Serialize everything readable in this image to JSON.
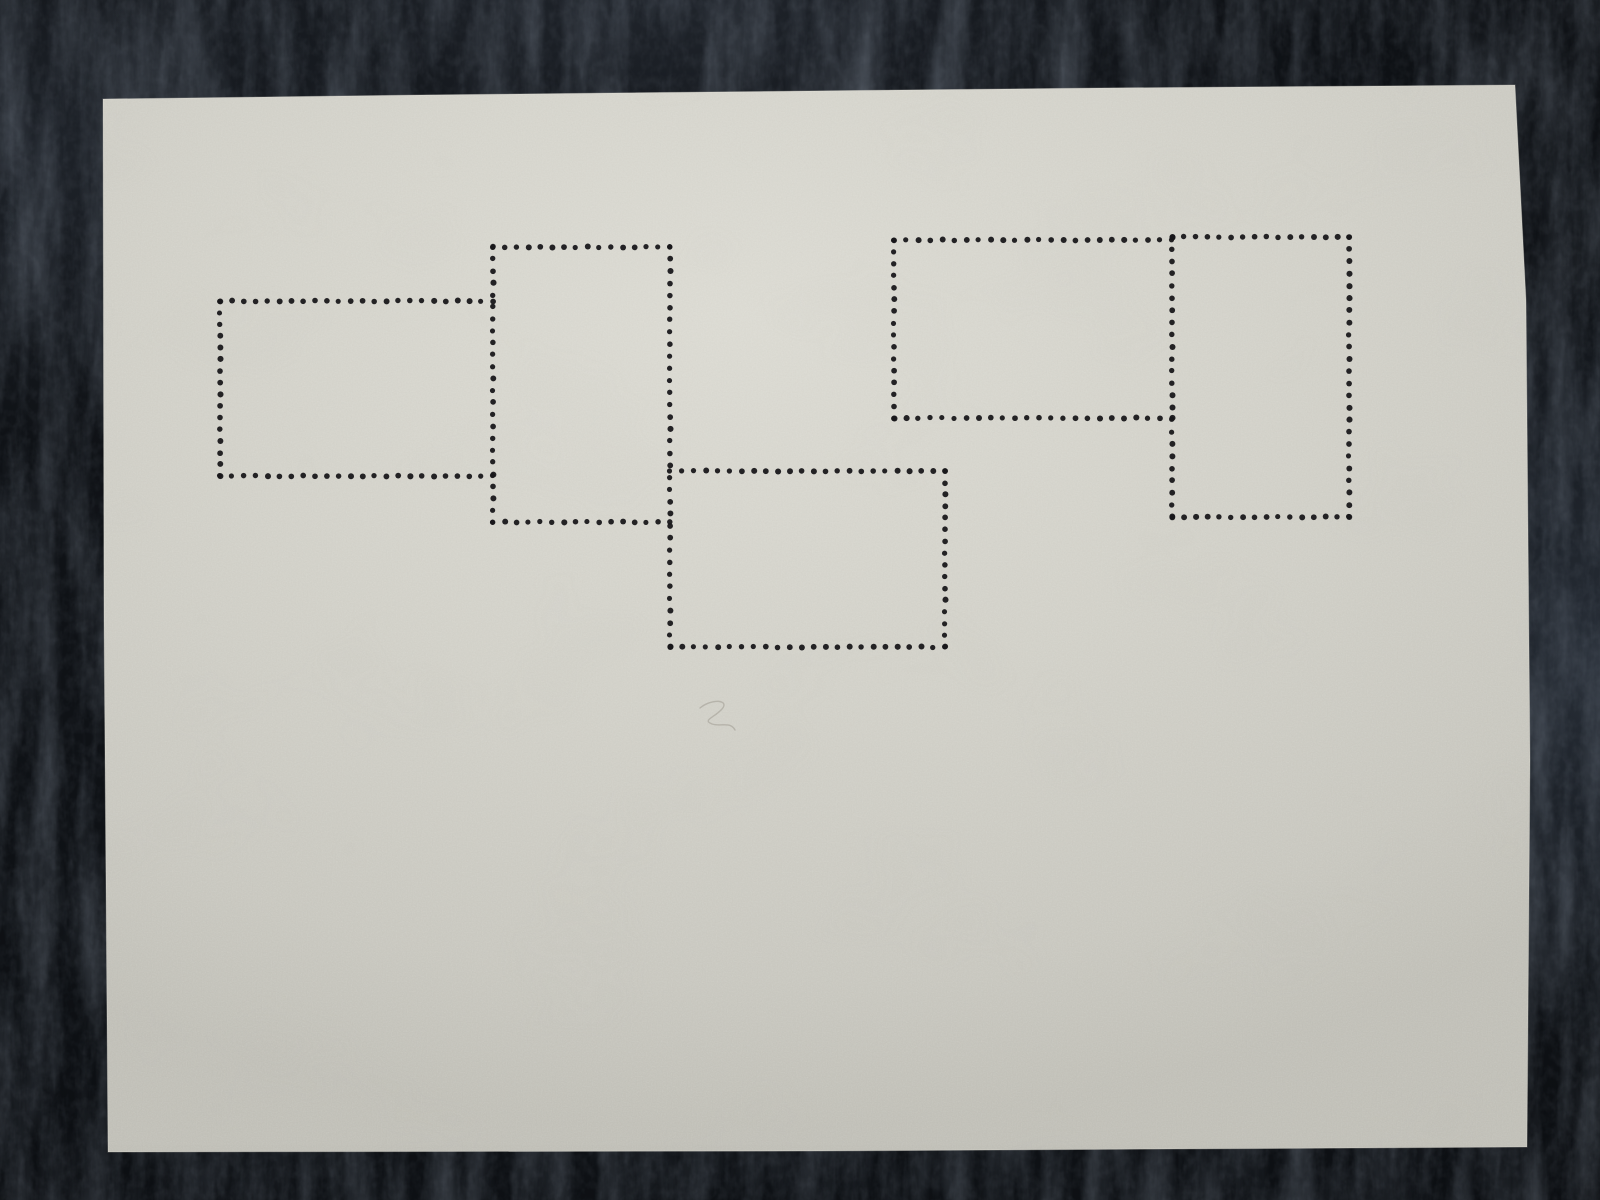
{
  "scene": {
    "width": 1600,
    "height": 1200
  },
  "colors": {
    "leather_base": "#080a0d",
    "leather_mid": "#14171c",
    "leather_sheen": "#3d4757",
    "paper_base": "#d2d1c9",
    "paper_light": "#dcdbd3",
    "paper_shade": "#c1c0b8",
    "perforation_dot": "#17161a",
    "pencil_mark": "#8a8478"
  },
  "paper": {
    "outline": [
      [
        103,
        99
      ],
      [
        420,
        95
      ],
      [
        1100,
        88
      ],
      [
        1515,
        85
      ],
      [
        1526,
        300
      ],
      [
        1530,
        760
      ],
      [
        1527,
        1147
      ],
      [
        820,
        1151
      ],
      [
        108,
        1152
      ],
      [
        104,
        620
      ]
    ]
  },
  "perforation": {
    "dot_spacing": 12.0,
    "dot_radius": 2.8,
    "stamp_frames": [
      {
        "x": 220,
        "y": 301,
        "width": 273,
        "height": 175
      },
      {
        "x": 493,
        "y": 247,
        "width": 177,
        "height": 275
      },
      {
        "x": 670,
        "y": 471,
        "width": 275,
        "height": 176
      },
      {
        "x": 894,
        "y": 240,
        "width": 278,
        "height": 178
      },
      {
        "x": 1172,
        "y": 237,
        "width": 177,
        "height": 280
      }
    ],
    "segments": {
      "vertical": [
        {
          "x": 220,
          "y1": 301,
          "y2": 476
        },
        {
          "x": 493,
          "y1": 247,
          "y2": 522
        },
        {
          "x": 670,
          "y1": 247,
          "y2": 647
        },
        {
          "x": 945,
          "y1": 471,
          "y2": 647
        },
        {
          "x": 894,
          "y1": 240,
          "y2": 418
        },
        {
          "x": 1172,
          "y1": 237,
          "y2": 517
        },
        {
          "x": 1349,
          "y1": 237,
          "y2": 517
        }
      ],
      "horizontal": [
        {
          "y": 301,
          "x1": 220,
          "x2": 493
        },
        {
          "y": 476,
          "x1": 220,
          "x2": 493
        },
        {
          "y": 247,
          "x1": 493,
          "x2": 670
        },
        {
          "y": 522,
          "x1": 493,
          "x2": 670
        },
        {
          "y": 471,
          "x1": 670,
          "x2": 945
        },
        {
          "y": 647,
          "x1": 670,
          "x2": 945
        },
        {
          "y": 240,
          "x1": 894,
          "x2": 1172
        },
        {
          "y": 418,
          "x1": 894,
          "x2": 1172
        },
        {
          "y": 237,
          "x1": 1172,
          "x2": 1349
        },
        {
          "y": 517,
          "x1": 1172,
          "x2": 1349
        }
      ]
    }
  },
  "pencil_mark": {
    "path": "M 700 708 C 712 698 730 700 722 709 C 714 718 702 720 712 724 C 721 727 730 721 735 730"
  }
}
